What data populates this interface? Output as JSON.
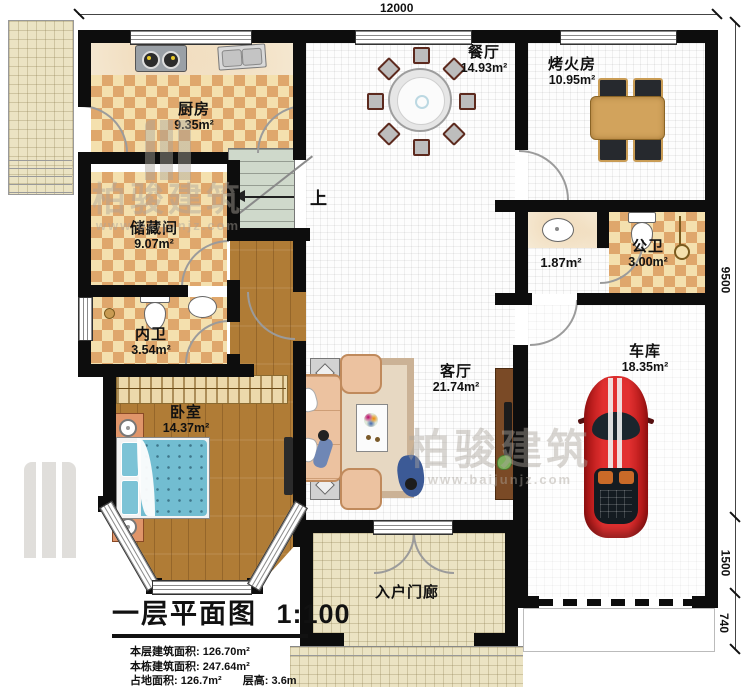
{
  "meta": {
    "title": "一层平面图",
    "scale": "1:100"
  },
  "dimensions": {
    "top": "12000",
    "right": [
      "9500",
      "1500",
      "740"
    ]
  },
  "rooms": {
    "kitchen": {
      "name": "厨房",
      "area": "9.35m²"
    },
    "dining": {
      "name": "餐厅",
      "area": "14.93m²"
    },
    "fire_room": {
      "name": "烤火房",
      "area": "10.95m²"
    },
    "storage": {
      "name": "储藏间",
      "area": "9.07m²"
    },
    "inner_bath": {
      "name": "内卫",
      "area": "3.54m²"
    },
    "public_bath": {
      "name": "公卫",
      "area": "3.00m²"
    },
    "wash_alcove": {
      "area": "1.87m²"
    },
    "bedroom": {
      "name": "卧室",
      "area": "14.37m²"
    },
    "living": {
      "name": "客厅",
      "area": "21.74m²"
    },
    "garage": {
      "name": "车库",
      "area": "18.35m²"
    },
    "porch": {
      "name": "入户门廊"
    }
  },
  "stairs": {
    "direction_label": "上"
  },
  "info": {
    "floor_area_label": "本层建筑面积",
    "floor_area": "126.70m²",
    "building_area_label": "本栋建筑面积",
    "building_area": "247.64m²",
    "footprint_label": "占地面积",
    "footprint": "126.7m²",
    "height_label": "层高",
    "height": "3.6m"
  },
  "watermark": {
    "name": "柏骏建筑",
    "url": "www.baijunjz.com"
  },
  "colors": {
    "wall": "#0d0d0d",
    "checker_dark": "#dfa76c",
    "checker_light": "#f4e0ae",
    "wood": "#b07c36",
    "bed_blue": "#72bdd1",
    "car_red": "#d92121",
    "stairs": "#cfd9cb",
    "porch_tile": "#ebe3c3"
  }
}
